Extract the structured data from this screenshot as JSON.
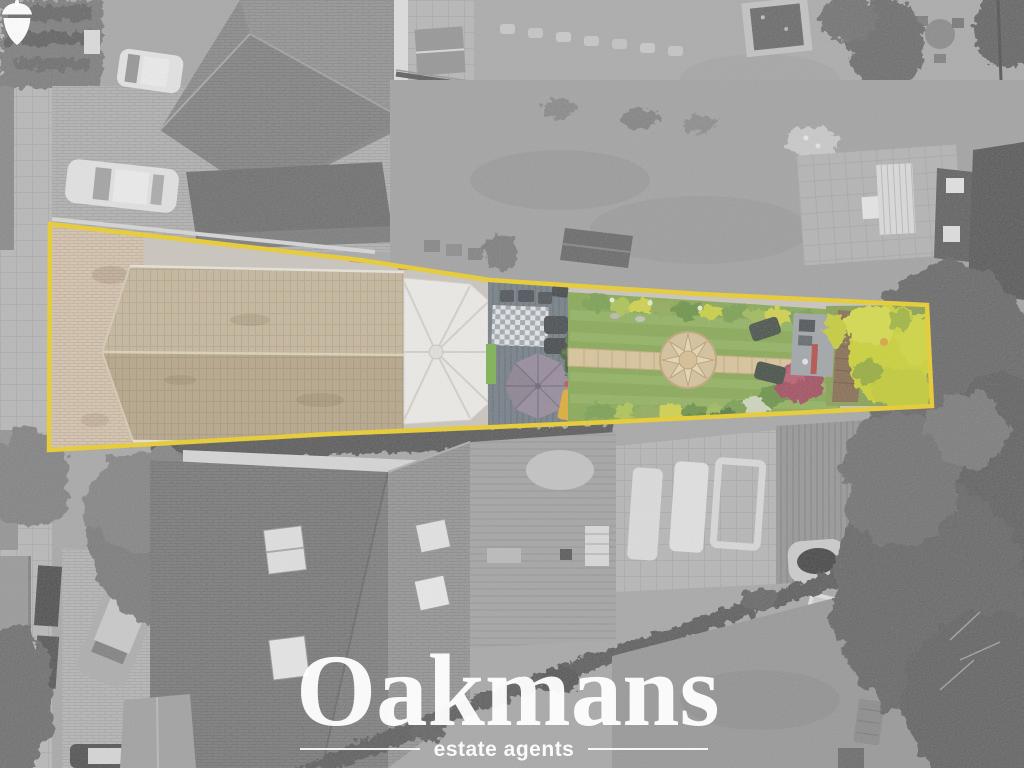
{
  "brand": {
    "name": "Oakmans",
    "tagline": "estate agents",
    "text_color": "#ffffff"
  },
  "annotation": {
    "type": "property-boundary-highlight",
    "boundary_color": "#F2CF0E"
  },
  "scene": {
    "style": "aerial drone photograph; highlighted plot in colour, surroundings desaturated",
    "palette": {
      "lawn": "#7DA441",
      "lawn_stripe": "#93B85A",
      "roof_tiles_lower": "#B3A07E",
      "roof_tiles_upper": "#C6B494",
      "driveway": "#D8C5AC",
      "stone_path": "#DCC492",
      "parasol": "#8E8093",
      "deck": "#66727C",
      "conservatory": "#F3F2EE",
      "yellow_shrubs": "#CCD41F",
      "red_shrub": "#9C3A50",
      "brown_fence": "#7C5E40"
    }
  }
}
